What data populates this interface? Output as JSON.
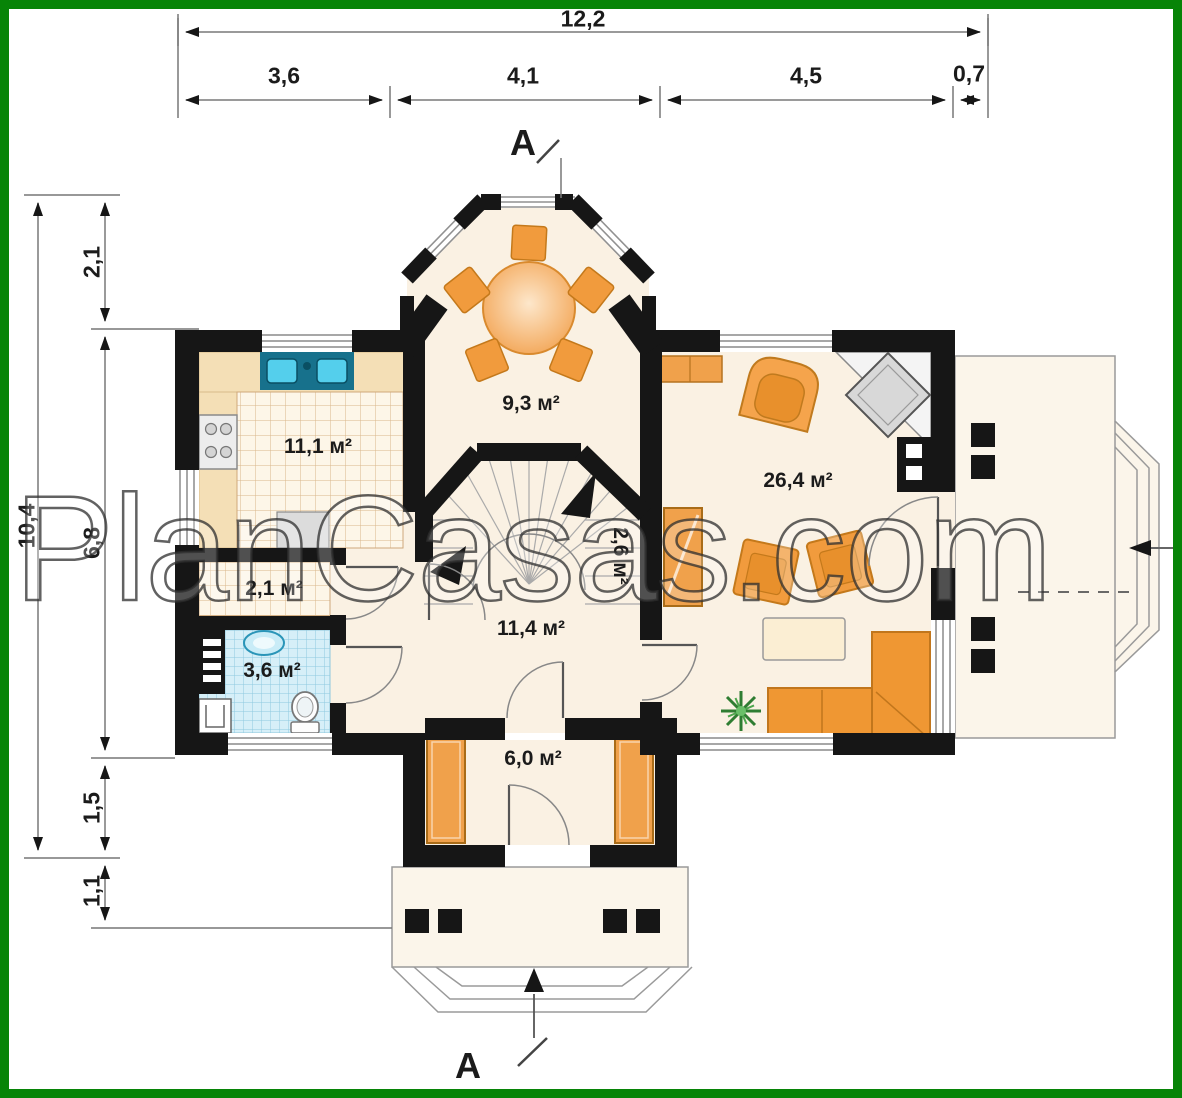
{
  "watermark": {
    "text": "PlanCasas.com"
  },
  "section_marks": {
    "top": "A",
    "bottom": "A"
  },
  "dimensions": {
    "top": {
      "total": "12,2",
      "segments": [
        "3,6",
        "4,1",
        "4,5",
        "0,7"
      ]
    },
    "left": {
      "total": "10,4",
      "segments": [
        "2,1",
        "6,8",
        "1,5",
        "1,1"
      ]
    }
  },
  "rooms": {
    "dining": {
      "area": "9,3 м²"
    },
    "kitchen": {
      "area": "11,1 м²"
    },
    "pantry": {
      "area": "2,1 м²"
    },
    "bathroom": {
      "area": "3,6 м²"
    },
    "hall": {
      "area": "11,4 м²"
    },
    "stairs": {
      "area": "2,6 м²"
    },
    "vestibule": {
      "area": "6,0 м²"
    },
    "living_room": {
      "area": "26,4 м²"
    }
  },
  "colors": {
    "frame_green": "#078407",
    "wall_black": "#161616",
    "floor_cream": "#faf1e3",
    "furniture_orange": "#f0953a",
    "tile_blue": "#d6eff8",
    "sink_teal": "#17718c",
    "plant_green": "#2f7d32"
  }
}
